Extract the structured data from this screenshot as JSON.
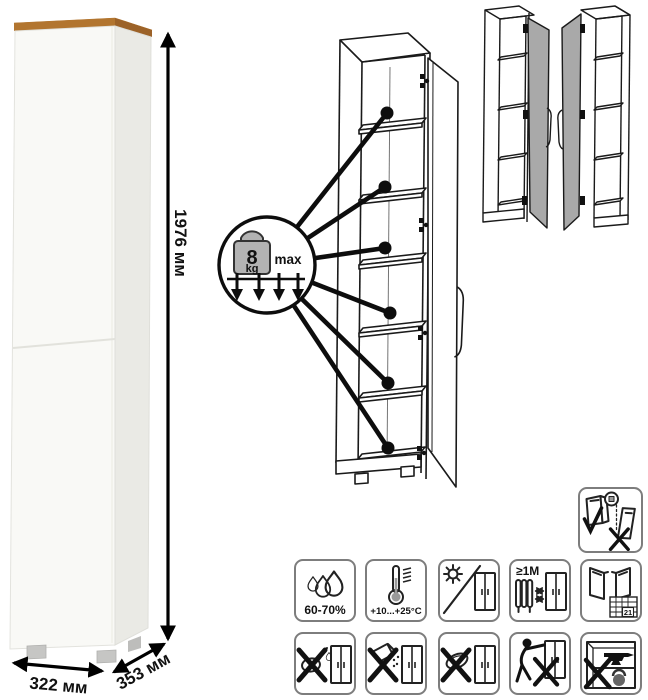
{
  "product": {
    "kind": "tall-one-door-cabinet"
  },
  "dims": {
    "height": "1976 мм",
    "width": "322 мм",
    "depth": "353 мм"
  },
  "load": {
    "value": "8",
    "unit": "kg",
    "max": "max",
    "shelf_callouts": 6
  },
  "care": {
    "humidity": "60-70%",
    "temperature": "+10...+25°C",
    "distance": "≥1M",
    "calendar": "21"
  },
  "icons": {
    "row1": [
      "humidity-icon",
      "temperature-icon",
      "no-direct-sunlight-icon",
      "heat-source-distance-icon",
      "ventilation-calendar-icon"
    ],
    "row2": [
      "no-wet-cleaning-icon",
      "no-abrasive-powder-icon",
      "no-scraping-icon",
      "no-dragging-icon",
      "no-heavy-items-icon"
    ],
    "safety": "anchor-to-wall-icon"
  },
  "colors": {
    "wood_top": "#c08a4a",
    "wood_top_light": "#d7a060",
    "wood_top_dark": "#9c6228",
    "door_gray": "#a9a9a9",
    "line": "#1a1a1a",
    "cabinet_front": "#f9f9f6",
    "cabinet_side": "#eaeae5"
  }
}
